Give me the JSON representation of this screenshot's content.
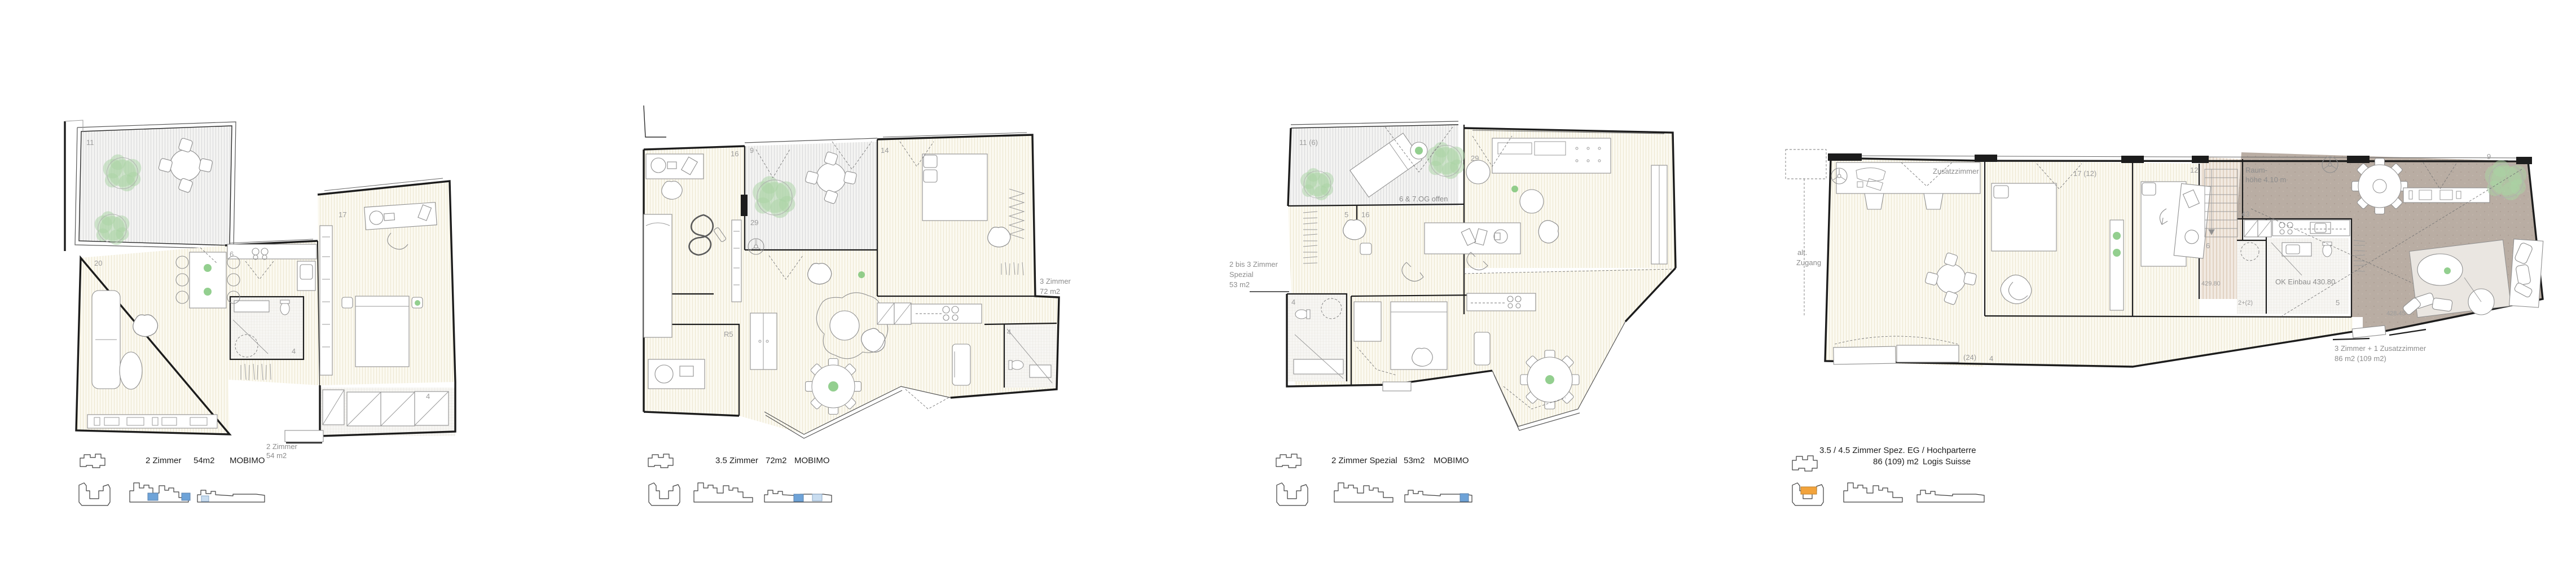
{
  "sheet": {
    "background": "#ffffff",
    "description": "Vier Wohnungsgrundrisse"
  },
  "colors": {
    "key_highlight_dark": "#6ea3d8",
    "key_highlight_light": "#c9ddf0",
    "key_highlight_orange": "#f2a33c",
    "wall": "#1c1c1c",
    "plant_green": "#a9d4a4",
    "concrete": "#b9ada3"
  },
  "plans": [
    {
      "caption": {
        "type": "2 Zimmer",
        "area": "54m2",
        "owner": "MOBIMO"
      },
      "annotation": {
        "line1": "2 Zimmer",
        "line2": "54 m2"
      },
      "rooms": {
        "terrace": "11",
        "living": "20",
        "kitchen": "6",
        "bedroom": "17",
        "bath": "4",
        "storage": "4"
      }
    },
    {
      "caption": {
        "type": "3.5 Zimmer",
        "area": "72m2",
        "owner": "MOBIMO"
      },
      "annotation": {
        "line1": "3 Zimmer",
        "line2": "72 m2"
      },
      "rooms": {
        "study": "16",
        "balcony": "9",
        "bedroom": "14",
        "living": "29",
        "utility": "R5",
        "bath": "4"
      }
    },
    {
      "caption": {
        "type": "2 Zimmer Spezial",
        "area": "53m2",
        "owner": "MOBIMO"
      },
      "annotation": {
        "line1": "2 bis 3 Zimmer",
        "line2": "Spezial",
        "line3": "53 m2"
      },
      "note": "6 & 7.OG offen",
      "rooms": {
        "terrace": "11 (6)",
        "living": "29",
        "room_a": "5",
        "room_b": "16",
        "bath": "4"
      }
    },
    {
      "caption": {
        "type": "3.5 / 4.5 Zimmer Spez. EG / Hochparterre",
        "area": "86 (109) m2",
        "owner": "Logis Suisse"
      },
      "annotation": {
        "line1": "3 Zimmer + 1 Zusatzzimmer",
        "line2": "86 m2 (109 m2)"
      },
      "rooms": {
        "zusatzzimmer": "Zusatzzimmer",
        "zusatz_count": "(24)",
        "hall": "4",
        "bedroom1": "17 (12)",
        "bedroom2": "12",
        "entry": "6",
        "living": "43",
        "reduit": "2+(2)",
        "bath": "5",
        "balcony": "9"
      },
      "labels": {
        "alt1": "alt.",
        "alt2": "Zugang",
        "raum1": "Raum-",
        "raum2": "höhe 4.10 m",
        "level1": "429.80",
        "level2": "428.45",
        "einbau": "OK Einbau 430.80"
      }
    }
  ]
}
